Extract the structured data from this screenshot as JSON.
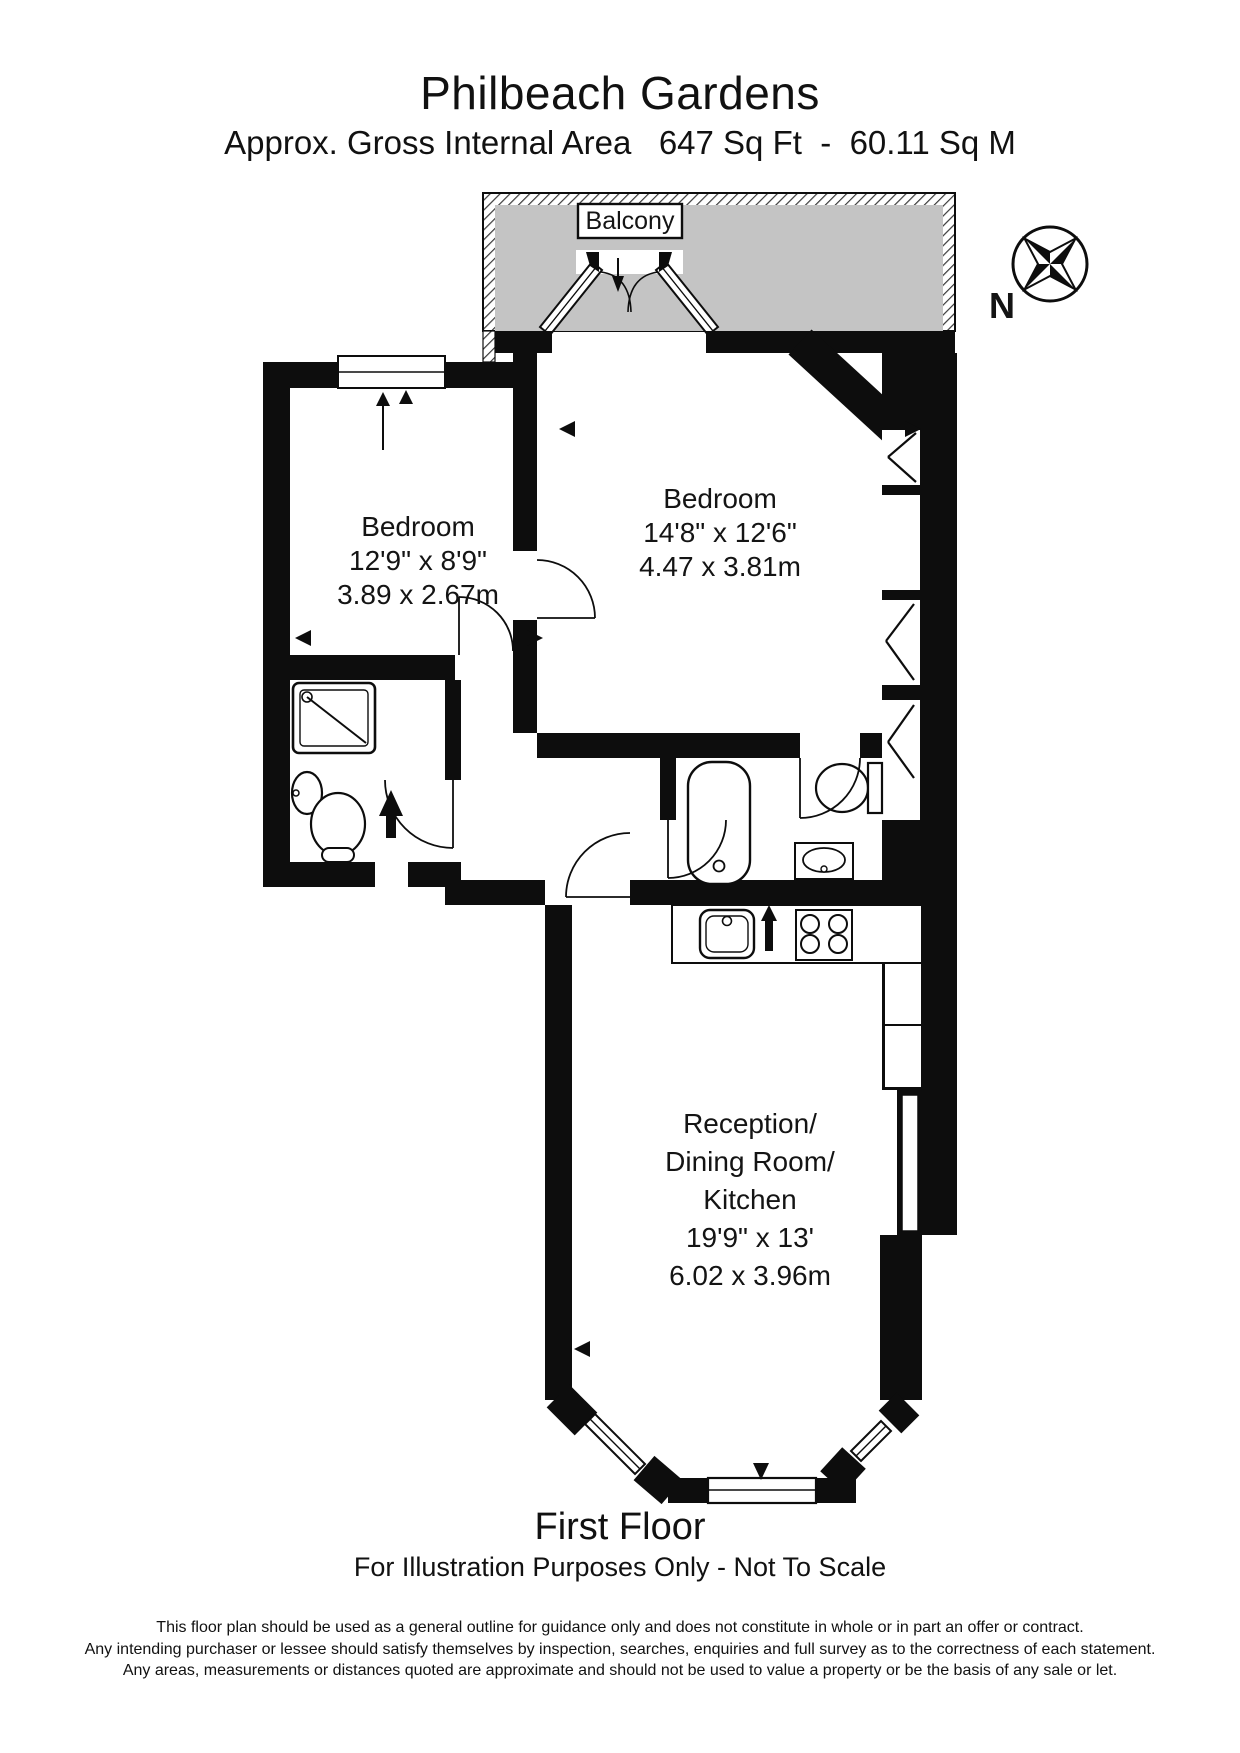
{
  "header": {
    "title": "Philbeach Gardens",
    "subtitle": "Approx. Gross Internal Area   647 Sq Ft  -  60.11 Sq M"
  },
  "plan": {
    "balcony_label": "Balcony",
    "compass_label": "N",
    "rooms": [
      {
        "name": "Bedroom",
        "dims_imperial": "12'9\" x 8'9\"",
        "dims_metric": "3.89 x 2.67m"
      },
      {
        "name": "Bedroom",
        "dims_imperial": "14'8\" x 12'6\"",
        "dims_metric": "4.47 x 3.81m"
      },
      {
        "name_lines": [
          "Reception/",
          "Dining Room/",
          "Kitchen"
        ],
        "dims_imperial": "19'9\" x 13'",
        "dims_metric": "6.02 x 3.96m"
      }
    ],
    "colors": {
      "wall": "#0d0d0d",
      "balcony_fill": "#c4c4c4",
      "paper": "#ffffff"
    }
  },
  "footer": {
    "floor_label": "First Floor",
    "scale_note": "For Illustration Purposes Only - Not To Scale",
    "disclaimer_lines": [
      "This floor plan should be used as a general outline for guidance only and does not constitute in whole or in part an offer or contract.",
      "Any intending purchaser or lessee should satisfy themselves by inspection, searches, enquiries and full survey as to the correctness of each statement.",
      "Any areas, measurements or distances quoted are approximate and should not be used to value a property or be the basis of any sale or let."
    ]
  }
}
